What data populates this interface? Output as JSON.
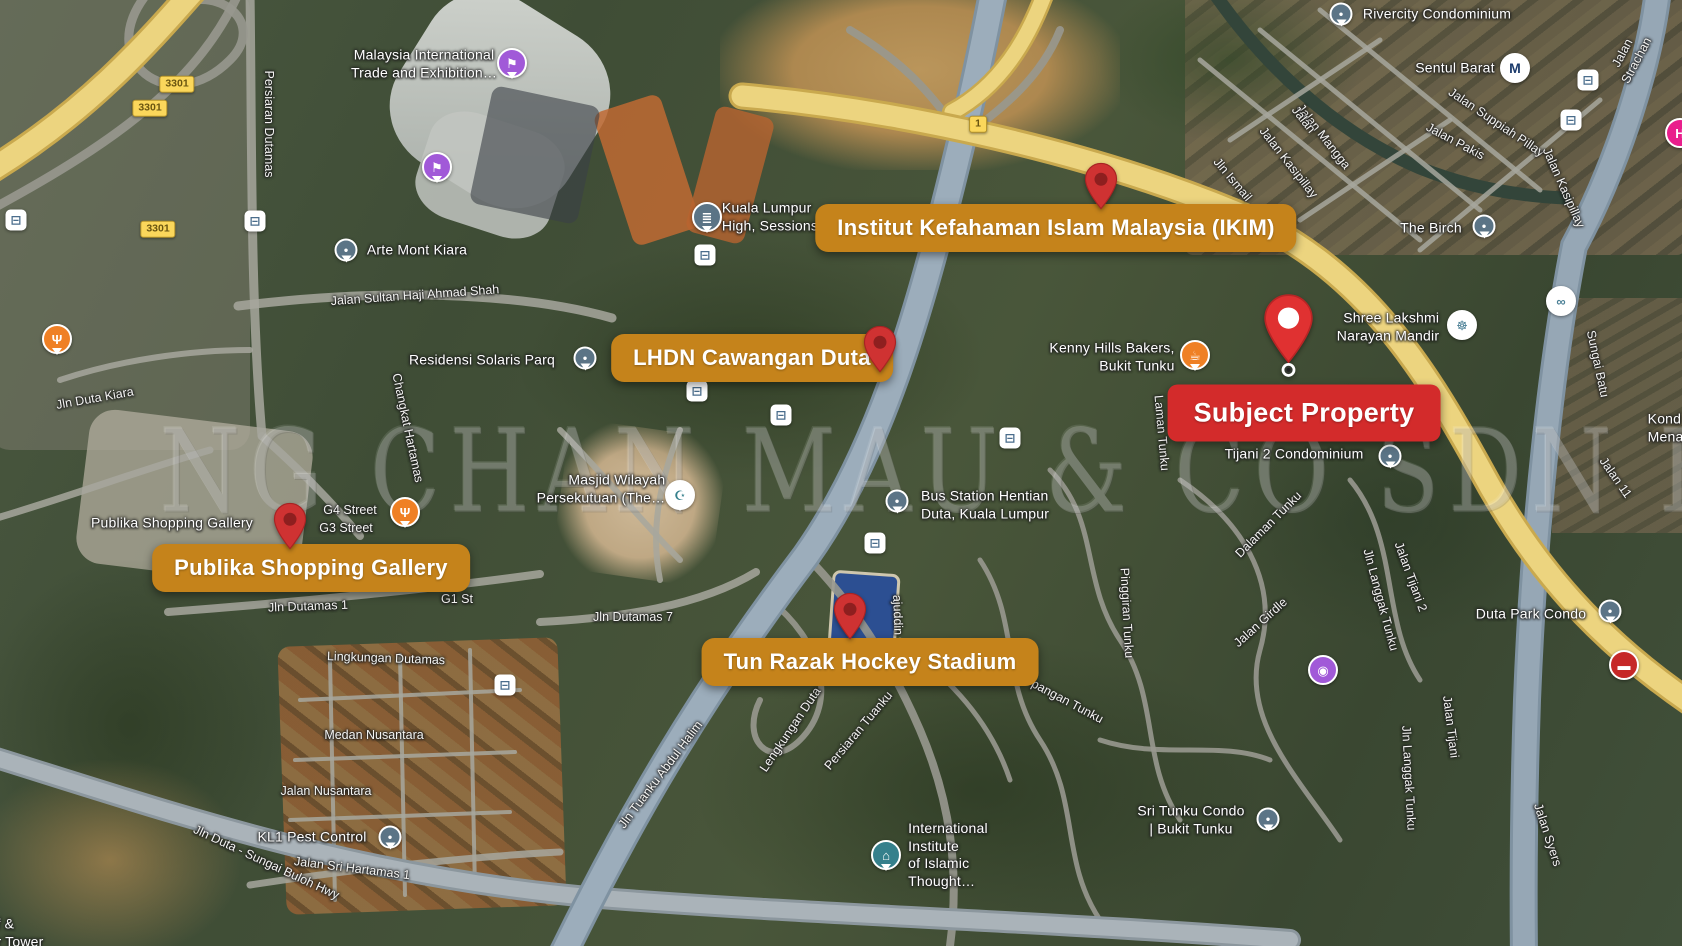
{
  "watermark": {
    "text": "NG CHAN MAU & CO SDN BHD"
  },
  "callouts": [
    {
      "label": "Institut Kefahaman Islam Malaysia (IKIM)",
      "style": "orange",
      "cx": 1056,
      "cy": 228,
      "pin": {
        "x": 1101,
        "y": 210,
        "w": 34
      }
    },
    {
      "label": "LHDN Cawangan Duta",
      "style": "orange",
      "cx": 752,
      "cy": 358,
      "pin": {
        "x": 880,
        "y": 373,
        "w": 34
      }
    },
    {
      "label": "Publika Shopping Gallery",
      "style": "orange",
      "cx": 311,
      "cy": 568,
      "pin": {
        "x": 290,
        "y": 550,
        "w": 34
      }
    },
    {
      "label": "Tun Razak Hockey Stadium",
      "style": "orange",
      "cx": 870,
      "cy": 662,
      "pin": {
        "x": 850,
        "y": 640,
        "w": 34
      }
    },
    {
      "label": "Subject Property",
      "style": "red",
      "cx": 1304,
      "cy": 413,
      "pin": {
        "x": 1288,
        "y": 378,
        "w": 51,
        "variant": "subject"
      }
    }
  ],
  "route_badges": [
    {
      "text": "3301",
      "x": 177,
      "y": 84
    },
    {
      "text": "3301",
      "x": 150,
      "y": 108
    },
    {
      "text": "3301",
      "x": 158,
      "y": 229
    },
    {
      "text": "1",
      "x": 978,
      "y": 124
    }
  ],
  "labels": [
    {
      "kind": "place",
      "lines": [
        "Malaysia International",
        "Trade and Exhibition…"
      ],
      "x": 424,
      "y": 64
    },
    {
      "kind": "place",
      "lines": [
        "Arte Mont Kiara"
      ],
      "x": 417,
      "y": 250
    },
    {
      "kind": "place",
      "lines": [
        "Kuala Lumpur",
        "High, Sessions"
      ],
      "x": 770,
      "y": 217,
      "align": "left"
    },
    {
      "kind": "place",
      "lines": [
        "Residensi Solaris Parq"
      ],
      "x": 482,
      "y": 360
    },
    {
      "kind": "place",
      "lines": [
        "Masjid Wilayah",
        "Persekutuan (The…"
      ],
      "x": 601,
      "y": 489,
      "align": "right"
    },
    {
      "kind": "place",
      "lines": [
        "Bus Station Hentian",
        "Duta, Kuala Lumpur"
      ],
      "x": 985,
      "y": 505,
      "align": "left"
    },
    {
      "kind": "place",
      "lines": [
        "Kenny Hills Bakers,",
        "Bukit Tunku"
      ],
      "x": 1112,
      "y": 357,
      "align": "right"
    },
    {
      "kind": "place",
      "lines": [
        "Rivercity Condominium"
      ],
      "x": 1437,
      "y": 14
    },
    {
      "kind": "place",
      "lines": [
        "Sentul Barat"
      ],
      "x": 1455,
      "y": 68
    },
    {
      "kind": "place",
      "lines": [
        "The Birch"
      ],
      "x": 1431,
      "y": 228
    },
    {
      "kind": "place",
      "lines": [
        "Shree Lakshmi",
        "Narayan Mandir"
      ],
      "x": 1388,
      "y": 327,
      "align": "right"
    },
    {
      "kind": "place",
      "lines": [
        "Kond",
        "Menar"
      ],
      "x": 1668,
      "y": 428,
      "align": "left"
    },
    {
      "kind": "place",
      "lines": [
        "Duta Park Condo"
      ],
      "x": 1531,
      "y": 614
    },
    {
      "kind": "place",
      "lines": [
        "Tijani 2 Condominium"
      ],
      "x": 1294,
      "y": 454
    },
    {
      "kind": "place",
      "lines": [
        "Sri Tunku Condo",
        "| Bukit Tunku"
      ],
      "x": 1191,
      "y": 820
    },
    {
      "kind": "place",
      "lines": [
        "International",
        "Institute",
        "of Islamic",
        "Thought…"
      ],
      "x": 948,
      "y": 855,
      "align": "left"
    },
    {
      "kind": "place",
      "lines": [
        "KL1 Pest Control"
      ],
      "x": 312,
      "y": 837
    },
    {
      "kind": "place",
      "lines": [
        "Publika Shopping Gallery"
      ],
      "x": 172,
      "y": 523
    },
    {
      "kind": "place",
      "lines": [
        "f &",
        "r Tower"
      ],
      "x": 20,
      "y": 933,
      "align": "left"
    },
    {
      "kind": "road",
      "text": "Persiaran Dutamas",
      "x": 268,
      "y": 124,
      "rot": 90
    },
    {
      "kind": "road",
      "text": "Jalan Sultan Haji Ahmad Shah",
      "x": 415,
      "y": 296,
      "rot": -4
    },
    {
      "kind": "road",
      "text": "Jln Duta Kiara",
      "x": 95,
      "y": 399,
      "rot": -10
    },
    {
      "kind": "road",
      "text": "Jalan Strachan",
      "x": 1630,
      "y": 57,
      "rot": -62
    },
    {
      "kind": "road",
      "text": "Jalan Suppiah Pillay",
      "x": 1496,
      "y": 123,
      "rot": 34
    },
    {
      "kind": "road",
      "text": "Jalan Pakis",
      "x": 1455,
      "y": 142,
      "rot": 28
    },
    {
      "kind": "road",
      "text": "Jalan Mangga",
      "x": 1323,
      "y": 137,
      "rot": 52
    },
    {
      "kind": "road",
      "text": "Jalan Kasipillay",
      "x": 1288,
      "y": 163,
      "rot": 52
    },
    {
      "kind": "road",
      "text": "Jln Ismail",
      "x": 1232,
      "y": 180,
      "rot": 50
    },
    {
      "kind": "road",
      "text": "Jalan",
      "x": 1303,
      "y": 120,
      "rot": 52
    },
    {
      "kind": "road",
      "text": "Jalan Kasipillay",
      "x": 1563,
      "y": 188,
      "rot": 66
    },
    {
      "kind": "road",
      "text": "Sungai Batu",
      "x": 1597,
      "y": 364,
      "rot": 78
    },
    {
      "kind": "road",
      "text": "Jalan 11",
      "x": 1615,
      "y": 478,
      "rot": 55
    },
    {
      "kind": "road",
      "text": "Jln Langgak Tunku",
      "x": 1380,
      "y": 600,
      "rot": 75
    },
    {
      "kind": "road",
      "text": "Jln Langgak Tunku",
      "x": 1408,
      "y": 778,
      "rot": 87
    },
    {
      "kind": "road",
      "text": "Jalan Tijani 2",
      "x": 1410,
      "y": 577,
      "rot": 70
    },
    {
      "kind": "road",
      "text": "Jalan Tijani",
      "x": 1450,
      "y": 727,
      "rot": 83
    },
    {
      "kind": "road",
      "text": "Jalan Syers",
      "x": 1547,
      "y": 835,
      "rot": 72
    },
    {
      "kind": "road",
      "text": "Dalaman Tunku",
      "x": 1269,
      "y": 525,
      "rot": -45
    },
    {
      "kind": "road",
      "text": "Jalan Girdle",
      "x": 1261,
      "y": 623,
      "rot": -42
    },
    {
      "kind": "road",
      "text": "Pinggiran Tunku",
      "x": 1126,
      "y": 613,
      "rot": 87
    },
    {
      "kind": "road",
      "text": "pangan Tunku",
      "x": 1067,
      "y": 702,
      "rot": 28
    },
    {
      "kind": "road",
      "text": "Laman Tunku",
      "x": 1161,
      "y": 433,
      "rot": 85
    },
    {
      "kind": "road",
      "text": "Jln Tuanku Abdul Halim",
      "x": 661,
      "y": 775,
      "rot": -53
    },
    {
      "kind": "road",
      "text": "Lengkungan Duta",
      "x": 791,
      "y": 730,
      "rot": -56
    },
    {
      "kind": "road",
      "text": "Persiaran Tuanku",
      "x": 859,
      "y": 731,
      "rot": -50
    },
    {
      "kind": "road",
      "text": "ajuddin",
      "x": 897,
      "y": 615,
      "rot": 88
    },
    {
      "kind": "road",
      "text": "Jalan Sri Hartamas 1",
      "x": 352,
      "y": 869,
      "rot": 7
    },
    {
      "kind": "road",
      "text": "Jln Duta - Sungai Buloh Hwy",
      "x": 266,
      "y": 863,
      "rot": 25
    },
    {
      "kind": "road",
      "text": "Medan Nusantara",
      "x": 374,
      "y": 736,
      "rot": 0
    },
    {
      "kind": "road",
      "text": "Jalan Nusantara",
      "x": 326,
      "y": 792,
      "rot": 0
    },
    {
      "kind": "road",
      "text": "Lingkungan Dutamas",
      "x": 386,
      "y": 659,
      "rot": 2
    },
    {
      "kind": "road",
      "text": "Jln Dutamas 1",
      "x": 308,
      "y": 607,
      "rot": -2
    },
    {
      "kind": "road",
      "text": "G4 Street",
      "x": 350,
      "y": 511,
      "rot": 0
    },
    {
      "kind": "road",
      "text": "G3 Street",
      "x": 346,
      "y": 529,
      "rot": 0
    },
    {
      "kind": "road",
      "text": "G1 St",
      "x": 457,
      "y": 600,
      "rot": 0
    },
    {
      "kind": "road",
      "text": "Jln Dutamas 7",
      "x": 633,
      "y": 618,
      "rot": 0
    },
    {
      "kind": "road",
      "text": "Changkat Hartamas",
      "x": 407,
      "y": 428,
      "rot": 78
    }
  ],
  "icon_defs": {
    "event": {
      "glyph": "⚑",
      "fg": "#ffffff",
      "bg": "#a159d8",
      "shape": "pin"
    },
    "restaurant": {
      "glyph": "Ψ",
      "fg": "#ffffff",
      "bg": "#ef8025",
      "shape": "pin"
    },
    "cafe": {
      "glyph": "☕",
      "fg": "#ffffff",
      "bg": "#ef8025",
      "shape": "pin"
    },
    "place": {
      "glyph": "●",
      "fg": "#ffffff",
      "bg": "#5b7486",
      "shape": "pin"
    },
    "courthouse": {
      "glyph": "≣",
      "fg": "#ffffff",
      "bg": "#5b7486",
      "shape": "pin"
    },
    "mosque": {
      "glyph": "☪",
      "fg": "#35808c",
      "bg": "#ffffff",
      "shape": "pin"
    },
    "temple": {
      "glyph": "☸",
      "fg": "#4a7f95",
      "bg": "#ffffff",
      "shape": "circle"
    },
    "bike": {
      "glyph": "∞",
      "fg": "#4a7f95",
      "bg": "#ffffff",
      "shape": "circle"
    },
    "school": {
      "glyph": "⌂",
      "fg": "#ffffff",
      "bg": "#35808c",
      "shape": "pin"
    },
    "camera": {
      "glyph": "◉",
      "fg": "#ffffff",
      "bg": "#a159d8",
      "shape": "circle"
    },
    "metro": {
      "glyph": "M",
      "fg": "#1b3a6b",
      "bg": "#ffffff",
      "shape": "circle"
    },
    "hospital": {
      "glyph": "H",
      "fg": "#ffffff",
      "bg": "#e91e8c",
      "shape": "circle"
    },
    "car": {
      "glyph": "▬",
      "fg": "#ffffff",
      "bg": "#c62828",
      "shape": "circle"
    },
    "bus": {
      "glyph": "⊟",
      "fg": "#4a6d8c",
      "bg": "#ffffff",
      "shape": "square"
    }
  },
  "icons": [
    {
      "type": "event",
      "x": 512,
      "y": 63
    },
    {
      "type": "event",
      "x": 437,
      "y": 167
    },
    {
      "type": "place",
      "x": 346,
      "y": 250
    },
    {
      "type": "courthouse",
      "x": 707,
      "y": 217
    },
    {
      "type": "place",
      "x": 585,
      "y": 358
    },
    {
      "type": "mosque",
      "x": 680,
      "y": 495
    },
    {
      "type": "place",
      "x": 897,
      "y": 501
    },
    {
      "type": "cafe",
      "x": 1195,
      "y": 355
    },
    {
      "type": "place",
      "x": 1341,
      "y": 14
    },
    {
      "type": "metro",
      "x": 1515,
      "y": 68
    },
    {
      "type": "place",
      "x": 1484,
      "y": 226
    },
    {
      "type": "temple",
      "x": 1462,
      "y": 325
    },
    {
      "type": "bike",
      "x": 1561,
      "y": 301
    },
    {
      "type": "place",
      "x": 1390,
      "y": 456
    },
    {
      "type": "place",
      "x": 1610,
      "y": 611
    },
    {
      "type": "car",
      "x": 1624,
      "y": 665
    },
    {
      "type": "camera",
      "x": 1323,
      "y": 670
    },
    {
      "type": "place",
      "x": 1268,
      "y": 819
    },
    {
      "type": "school",
      "x": 886,
      "y": 855
    },
    {
      "type": "place",
      "x": 390,
      "y": 837
    },
    {
      "type": "restaurant",
      "x": 57,
      "y": 339
    },
    {
      "type": "restaurant",
      "x": 405,
      "y": 512
    },
    {
      "type": "bus",
      "x": 16,
      "y": 220
    },
    {
      "type": "bus",
      "x": 255,
      "y": 221
    },
    {
      "type": "bus",
      "x": 705,
      "y": 255
    },
    {
      "type": "bus",
      "x": 697,
      "y": 391
    },
    {
      "type": "bus",
      "x": 781,
      "y": 415
    },
    {
      "type": "bus",
      "x": 875,
      "y": 543
    },
    {
      "type": "bus",
      "x": 1010,
      "y": 438
    },
    {
      "type": "bus",
      "x": 505,
      "y": 685
    },
    {
      "type": "bus",
      "x": 1588,
      "y": 80
    },
    {
      "type": "bus",
      "x": 1571,
      "y": 120
    },
    {
      "type": "hospital",
      "x": 1680,
      "y": 133
    }
  ]
}
